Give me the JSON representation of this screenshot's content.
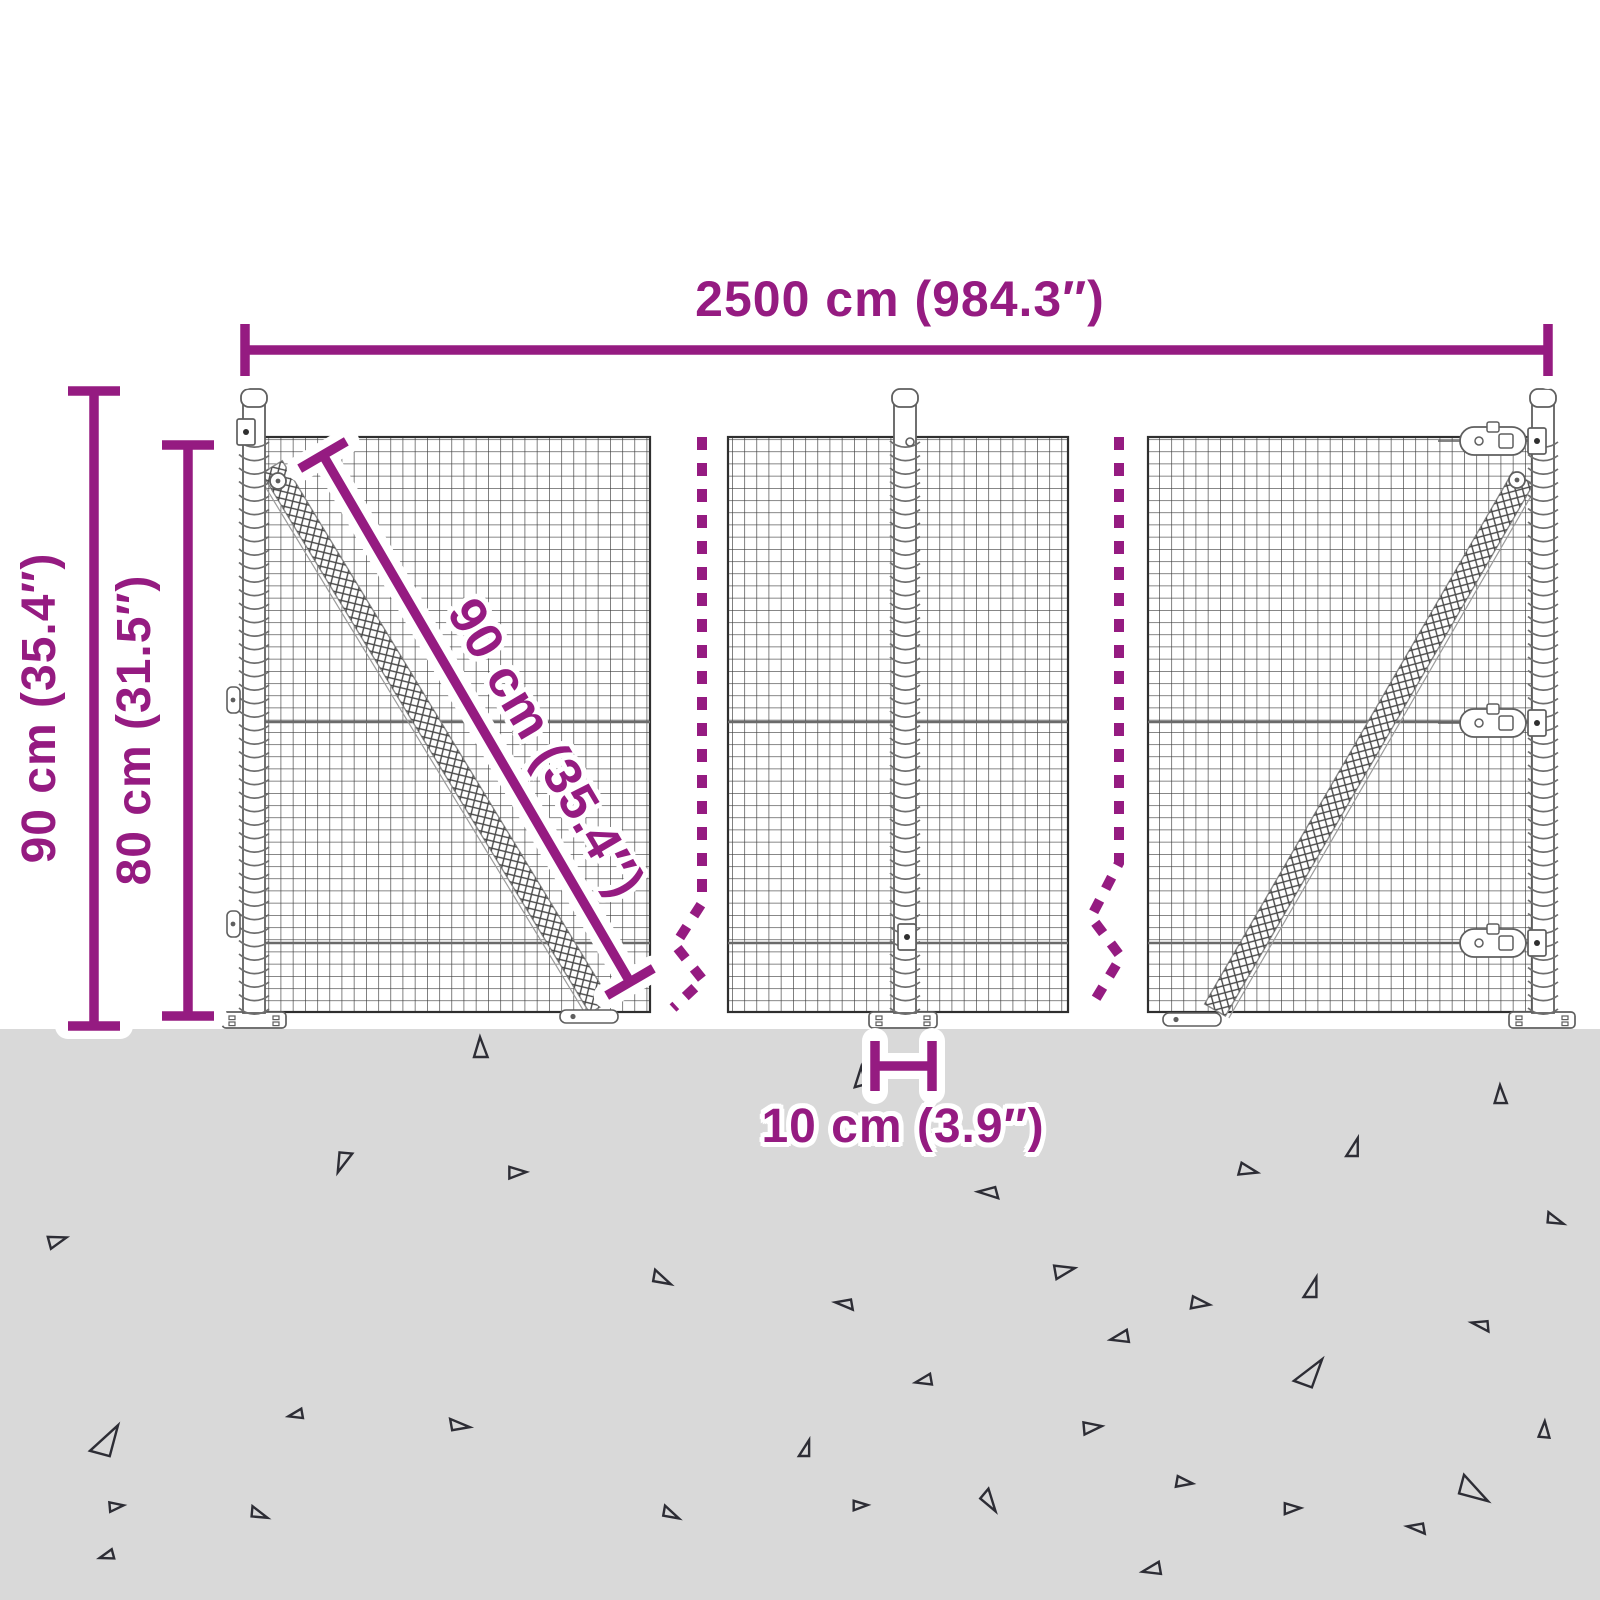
{
  "title": "Wire mesh fence dimension diagram",
  "colors": {
    "accent": "#951b81",
    "ground": "#d9d9d9",
    "mesh": "#3c3c3c",
    "frame": "#2f2f2f",
    "metal": "#5f5f5f",
    "coil": "#6e6e6e",
    "hatch": "#4a4a4a",
    "wire": "#6a6a6a",
    "triangle": "#2d2d35",
    "halo": "#ffffff"
  },
  "labels": {
    "total_width": "2500 cm (984.3″)",
    "post_height": "90 cm (35.4″)",
    "mesh_height": "80 cm (31.5″)",
    "brace_length": "90 cm (35.4″)",
    "plate_width": "10 cm (3.9″)"
  },
  "measurements": {
    "total_width_cm": 2500,
    "total_width_in": 984.3,
    "post_height_cm": 90,
    "post_height_in": 35.4,
    "mesh_height_cm": 80,
    "mesh_height_in": 31.5,
    "brace_length_cm": 90,
    "brace_length_in": 35.4,
    "plate_width_cm": 10,
    "plate_width_in": 3.9
  },
  "geometry": {
    "ground_y": 1029,
    "mesh_top": 437,
    "mesh_bottom": 1012,
    "cell": 12.2,
    "wires_y": [
      722,
      943
    ],
    "panels": [
      {
        "x": 258,
        "w": 392
      },
      {
        "x": 728,
        "w": 340
      },
      {
        "x": 1148,
        "w": 384
      }
    ],
    "braces": [
      {
        "x1": 272,
        "y1": 467,
        "x2": 600,
        "y2": 1007,
        "foot_x": 560,
        "foot_w": 58,
        "circle": [
          278,
          481
        ]
      },
      {
        "x1": 1215,
        "y1": 1010,
        "x2": 1523,
        "y2": 478,
        "foot_x": 1163,
        "foot_w": 58,
        "circle": [
          1517,
          480
        ]
      }
    ],
    "posts": [
      {
        "cx": 254,
        "top": 389,
        "plate": [
          222,
          286
        ],
        "hardware": [
          {
            "t": "square",
            "x": 246,
            "y": 432
          },
          {
            "t": "tab",
            "x": 233,
            "y": 700
          },
          {
            "t": "tab",
            "x": 233,
            "y": 924
          }
        ]
      },
      {
        "cx": 905,
        "top": 389,
        "plate": [
          869,
          937
        ],
        "hardware": [
          {
            "t": "bolt",
            "x": 910,
            "y": 442
          },
          {
            "t": "square",
            "x": 907,
            "y": 937
          }
        ]
      },
      {
        "cx": 1543,
        "top": 389,
        "plate": [
          1509,
          1575
        ],
        "hardware": [
          {
            "t": "capsule",
            "x": 1493,
            "y": 441
          },
          {
            "t": "capsule",
            "x": 1493,
            "y": 723
          },
          {
            "t": "capsule",
            "x": 1493,
            "y": 943
          },
          {
            "t": "square",
            "x": 1537,
            "y": 441
          },
          {
            "t": "square",
            "x": 1537,
            "y": 723
          },
          {
            "t": "square",
            "x": 1537,
            "y": 943
          }
        ]
      }
    ],
    "breaks": [
      "M702 437 L702 903 L675 945 L703 980 L673 1008",
      "M1119 437 L1119 863 L1091 917 L1121 957 L1092 1005"
    ],
    "dims": {
      "top": {
        "x1": 245,
        "y1": 350,
        "x2": 1548,
        "y2": 350,
        "cap": 26
      },
      "left1": {
        "x1": 94,
        "y1": 391,
        "x2": 94,
        "y2": 1026,
        "cap": 26
      },
      "left2": {
        "x1": 188,
        "y1": 445,
        "x2": 188,
        "y2": 1016,
        "cap": 26
      },
      "diag": {
        "x1": 323,
        "y1": 455,
        "x2": 630,
        "y2": 982,
        "cap": 27
      },
      "plate": {
        "x1": 875,
        "y1": 1066,
        "x2": 932,
        "y2": 1066,
        "cap": 25
      }
    },
    "triangles": [
      {
        "x": 480,
        "y": 1048,
        "s": 20,
        "r": 0
      },
      {
        "x": 858,
        "y": 1077,
        "s": 18,
        "r": -15
      },
      {
        "x": 1500,
        "y": 1095,
        "s": 18,
        "r": 0
      },
      {
        "x": 345,
        "y": 1163,
        "s": 20,
        "r": 185
      },
      {
        "x": 517,
        "y": 1172,
        "s": 17,
        "r": 90
      },
      {
        "x": 1352,
        "y": 1147,
        "s": 18,
        "r": 0
      },
      {
        "x": 1248,
        "y": 1170,
        "s": 18,
        "r": 105
      },
      {
        "x": 988,
        "y": 1195,
        "s": 18,
        "r": -105
      },
      {
        "x": 57,
        "y": 1240,
        "s": 18,
        "r": 75
      },
      {
        "x": 663,
        "y": 1277,
        "s": 18,
        "r": 100
      },
      {
        "x": 1064,
        "y": 1270,
        "s": 20,
        "r": 80
      },
      {
        "x": 1310,
        "y": 1287,
        "s": 20,
        "r": 0
      },
      {
        "x": 1200,
        "y": 1303,
        "s": 18,
        "r": 100
      },
      {
        "x": 844,
        "y": 1306,
        "s": 16,
        "r": -100
      },
      {
        "x": 1120,
        "y": 1338,
        "s": 18,
        "r": -100
      },
      {
        "x": 1480,
        "y": 1327,
        "s": 16,
        "r": -95
      },
      {
        "x": 924,
        "y": 1381,
        "s": 16,
        "r": -100
      },
      {
        "x": 1308,
        "y": 1370,
        "s": 30,
        "r": 20
      },
      {
        "x": 1092,
        "y": 1427,
        "s": 18,
        "r": 85
      },
      {
        "x": 804,
        "y": 1448,
        "s": 16,
        "r": 0
      },
      {
        "x": 1544,
        "y": 1430,
        "s": 16,
        "r": 5
      },
      {
        "x": 104,
        "y": 1438,
        "s": 32,
        "r": 15
      },
      {
        "x": 296,
        "y": 1415,
        "s": 14,
        "r": -100
      },
      {
        "x": 460,
        "y": 1423,
        "s": 18,
        "r": 80
      },
      {
        "x": 1184,
        "y": 1482,
        "s": 16,
        "r": 100
      },
      {
        "x": 992,
        "y": 1500,
        "s": 20,
        "r": 130
      },
      {
        "x": 860,
        "y": 1505,
        "s": 14,
        "r": 90
      },
      {
        "x": 1476,
        "y": 1488,
        "s": 30,
        "r": 105
      },
      {
        "x": 1292,
        "y": 1508,
        "s": 16,
        "r": 90
      },
      {
        "x": 1416,
        "y": 1530,
        "s": 16,
        "r": -100
      },
      {
        "x": 1152,
        "y": 1570,
        "s": 18,
        "r": -100
      },
      {
        "x": 260,
        "y": 1512,
        "s": 16,
        "r": 95
      },
      {
        "x": 116,
        "y": 1506,
        "s": 14,
        "r": 85
      },
      {
        "x": 672,
        "y": 1512,
        "s": 16,
        "r": 100
      },
      {
        "x": 107,
        "y": 1556,
        "s": 14,
        "r": -105
      },
      {
        "x": 1556,
        "y": 1218,
        "s": 16,
        "r": 95
      }
    ]
  }
}
